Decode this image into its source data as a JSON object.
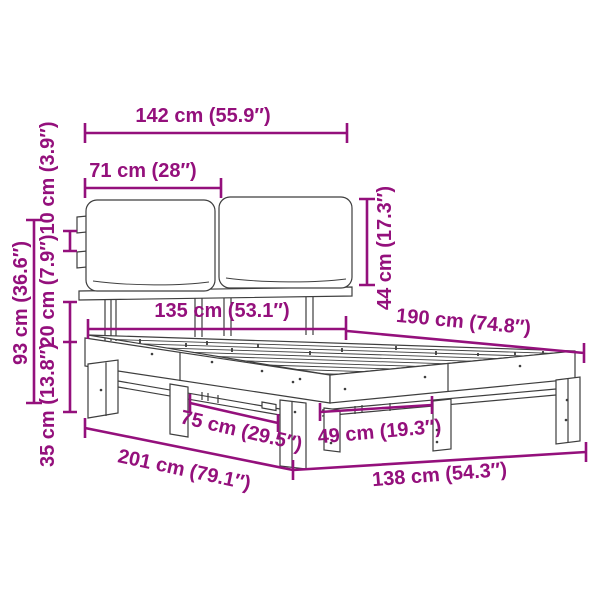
{
  "page": {
    "background": "#ffffff"
  },
  "colors": {
    "dimension_accent": "#94107C",
    "line_art": "#3e3e3e"
  },
  "diagram": {
    "product": "bed-frame-with-cushion-headboard-dimension-diagram",
    "labels": {
      "headboard_width": "142 cm (55.9″)",
      "cushion_width": "71 cm (28″)",
      "cushion_gap": "10 cm (3.9″)",
      "headboard_height": "93 cm (36.6″)",
      "frame_gap": "20 cm (7.9″)",
      "frame_height": "35 cm (13.8″)",
      "cushion_height": "44 cm (17.3″)",
      "bed_width": "135 cm (53.1″)",
      "bed_length": "190 cm (74.8″)",
      "side_leg_spacing": "75 cm (29.5″)",
      "foot_leg_spacing": "49 cm (19.3″)",
      "overall_length": "201 cm (79.1″)",
      "overall_width": "138 cm (54.3″)"
    }
  }
}
